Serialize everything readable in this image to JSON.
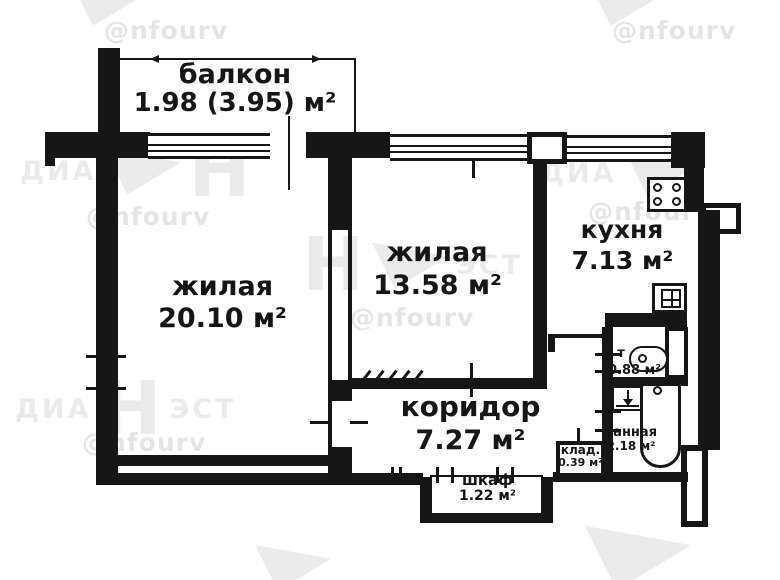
{
  "rooms": {
    "balcony": {
      "name": "балкон",
      "area": "1.98 (3.95) м²"
    },
    "living1": {
      "name": "жилая",
      "area": "20.10 м²"
    },
    "living2": {
      "name": "жилая",
      "area": "13.58 м²"
    },
    "kitchen": {
      "name": "кухня",
      "area": "7.13 м²"
    },
    "corridor": {
      "name": "коридор",
      "area": "7.27 м²"
    },
    "toilet": {
      "label": "т",
      "area": "0.88 м²"
    },
    "bathroom": {
      "name": "ванная",
      "area": "2.18 м²"
    },
    "pantry": {
      "name": "клад.",
      "area": "0.39 м²"
    },
    "closet": {
      "name": "шкаф",
      "area": "1.22 м²"
    }
  },
  "watermark": {
    "handle": "@nfourv",
    "brand_left": "ДИА",
    "brand_h": "Н",
    "brand_right": "ЭСТ"
  },
  "colors": {
    "wall": "#161616",
    "background": "#ffffff"
  }
}
